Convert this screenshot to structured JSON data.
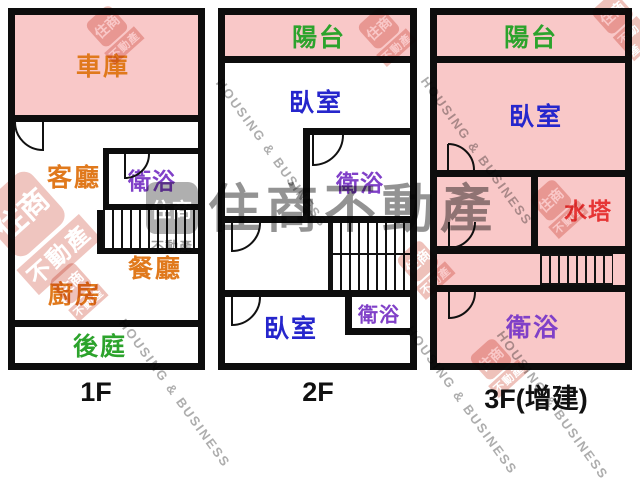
{
  "floors": [
    {
      "label": "1F",
      "rooms": {
        "garage": "車庫",
        "living": "客廳",
        "bathroom": "衛浴",
        "dining": "餐廳",
        "kitchen": "廚房",
        "backyard": "後庭"
      }
    },
    {
      "label": "2F",
      "rooms": {
        "balcony": "陽台",
        "bedroom_upper": "臥室",
        "bathroom_mid": "衛浴",
        "bathroom_small": "衛浴",
        "bedroom_lower": "臥室"
      }
    },
    {
      "label": "3F(增建)",
      "rooms": {
        "balcony": "陽台",
        "bedroom": "臥室",
        "water_tank": "水塔",
        "bathroom": "衛浴"
      }
    }
  ],
  "watermark": {
    "brand_cjk": "住商不動產",
    "brand_en": "HOUSING & BUSINESS",
    "logo_top": "住商",
    "logo_bottom": "不動產"
  },
  "colors": {
    "room_pink": "#f9c8c8",
    "wall_black": "#0d0d0d",
    "label_orange": "#e0791c",
    "label_purple": "#8040c8",
    "label_green": "#2ca32c",
    "label_blue": "#2626cc",
    "label_red": "#e63535",
    "watermark_gray": "#8a8a8a",
    "stamp_red": "#c83c28"
  }
}
